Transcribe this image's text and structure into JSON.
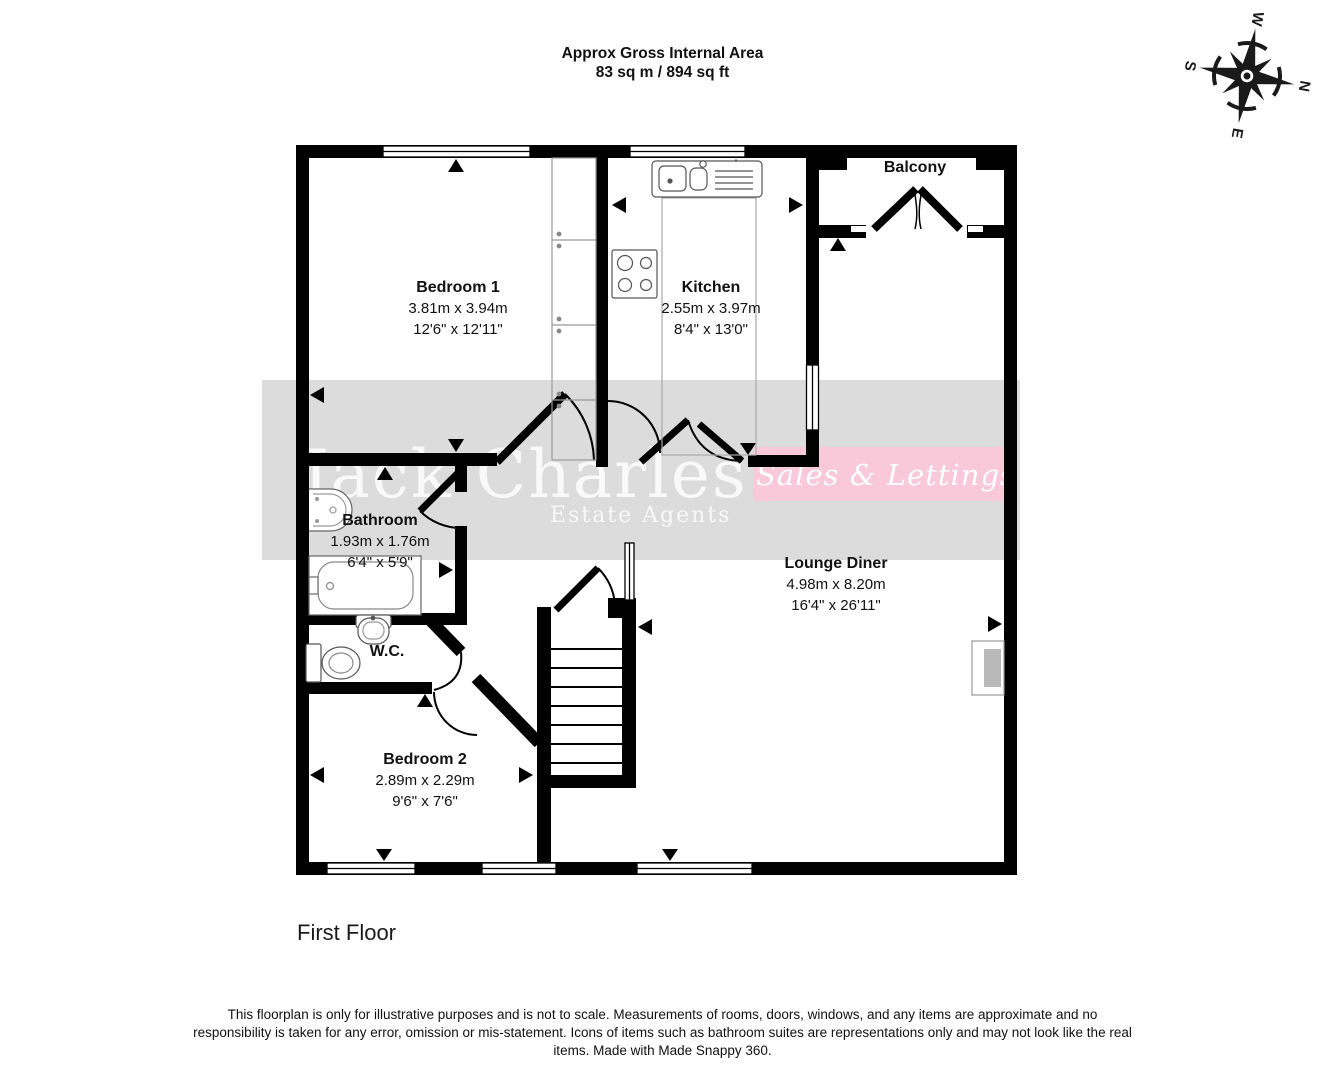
{
  "header": {
    "line1": "Approx Gross Internal Area",
    "line2": "83 sq m / 894 sq ft"
  },
  "compass": {
    "n": "N",
    "e": "E",
    "s": "S",
    "w": "W"
  },
  "rooms": {
    "bedroom1": {
      "name": "Bedroom 1",
      "metric": "3.81m x 3.94m",
      "imperial": "12'6\" x 12'11\""
    },
    "kitchen": {
      "name": "Kitchen",
      "metric": "2.55m x 3.97m",
      "imperial": "8'4\" x 13'0\""
    },
    "balcony": {
      "name": "Balcony"
    },
    "bathroom": {
      "name": "Bathroom",
      "metric": "1.93m x 1.76m",
      "imperial": "6'4\" x 5'9\""
    },
    "wc": {
      "name": "W.C."
    },
    "bedroom2": {
      "name": "Bedroom 2",
      "metric": "2.89m x 2.29m",
      "imperial": "9'6\" x 7'6\""
    },
    "lounge": {
      "name": "Lounge Diner",
      "metric": "4.98m x 8.20m",
      "imperial": "16'4\" x 26'11\""
    }
  },
  "watermark": {
    "brand": "Jack Charles",
    "sub": "Estate Agents",
    "banner": "Sales & Lettings",
    "band_color": "#dcdcdc",
    "banner_color": "#f9c9da"
  },
  "floor_label": "First Floor",
  "footer": {
    "disclaimer": "This floorplan is only for illustrative purposes and is not to scale. Measurements of rooms, doors, windows, and any items are approximate and no responsibility is taken for any error, omission or mis-statement. Icons of items such as bathroom suites are representations only and may not look like the real items. Made with Made Snappy 360."
  }
}
